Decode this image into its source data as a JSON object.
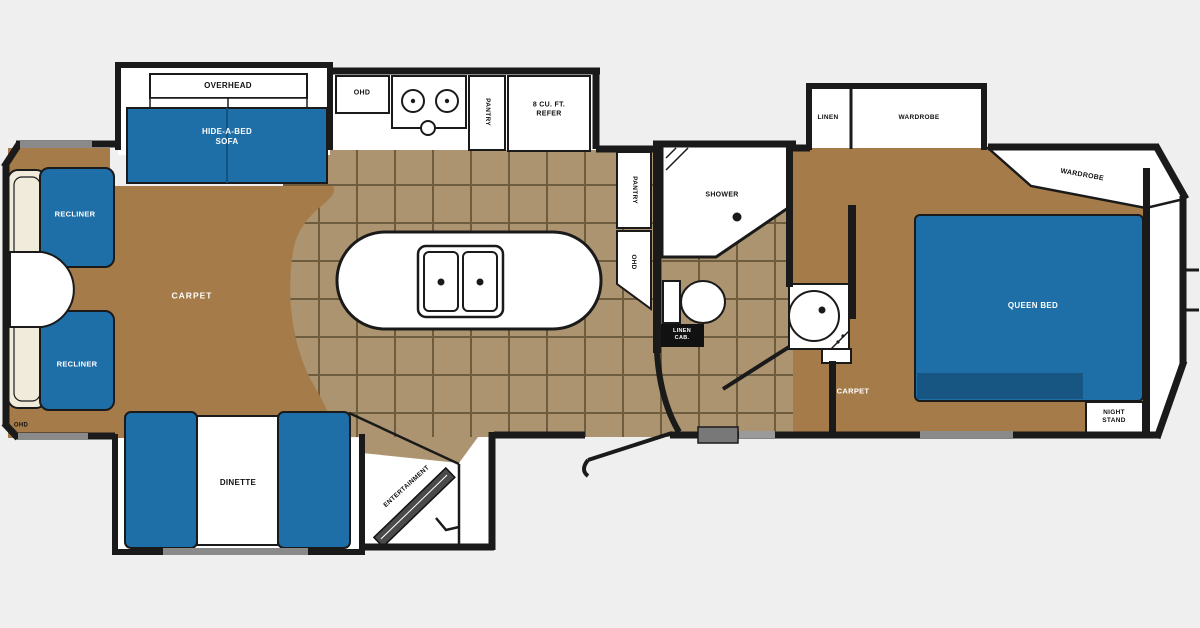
{
  "title": "Fifth wheel RV floor plan",
  "colors": {
    "background": "#efefef",
    "wall": "#1a1a1a",
    "carpet": "#a57b49",
    "tile": "#ac9471",
    "tile_line": "#6e5c3e",
    "furniture_blue": "#1e6ea7",
    "furniture_blue_dark": "#175683",
    "cream": "#f1ebdc",
    "slide_marker_gray": "#8a8a8a",
    "white": "#ffffff"
  },
  "living": {
    "carpet_label": "CARPET",
    "recliner_top": "RECLINER",
    "recliner_bottom": "RECLINER",
    "sofa": "HIDE-A-BED\nSOFA",
    "overhead": "OVERHEAD",
    "rear_ohd": "OHD"
  },
  "kitchen": {
    "ohd": "OHD",
    "pantry": "PANTRY",
    "refrigerator": "8 CU. FT.\nREFER",
    "pantry_tall": "PANTRY",
    "ohd_tall": "OHD"
  },
  "dinette": {
    "label": "DINETTE"
  },
  "entertainment": {
    "label": "ENTERTAINMENT"
  },
  "bathroom": {
    "shower": "SHOWER",
    "linen_cab": "LINEN\nCAB."
  },
  "bedroom": {
    "linen": "LINEN",
    "wardrobe_slide": "WARDROBE",
    "wardrobe_front": "WARDROBE",
    "queen_bed": "QUEEN BED",
    "carpet_label": "CARPET",
    "night_stand": "NIGHT\nSTAND"
  }
}
